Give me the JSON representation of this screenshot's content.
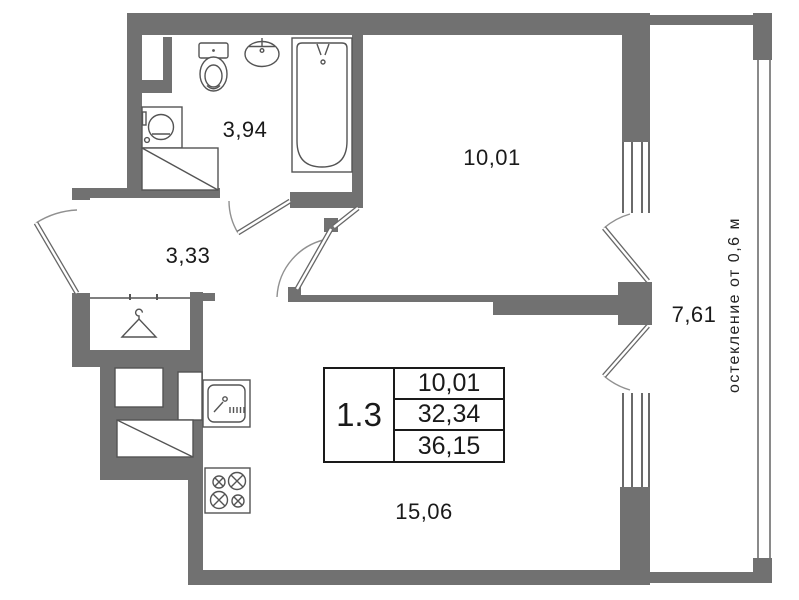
{
  "stamp": {
    "unit_number": "1.3",
    "rows": [
      "10,01",
      "32,34",
      "36,15"
    ]
  },
  "rooms": {
    "bathroom": "3,94",
    "hallway": "3,33",
    "bedroom": "10,01",
    "living_kitchen": "15,06",
    "balcony": "7,61"
  },
  "notes": {
    "glazing": "остекление от 0,6 м"
  },
  "colors": {
    "wall": "#717171",
    "fixture_line": "#545454",
    "text": "#1a1a1a"
  },
  "icons": [
    "toilet-icon",
    "washbasin-icon",
    "bathtub-icon",
    "washing-machine-icon",
    "hanger-icon",
    "kitchen-sink-icon",
    "stove-icon",
    "window-icon",
    "door-swing-icon"
  ]
}
